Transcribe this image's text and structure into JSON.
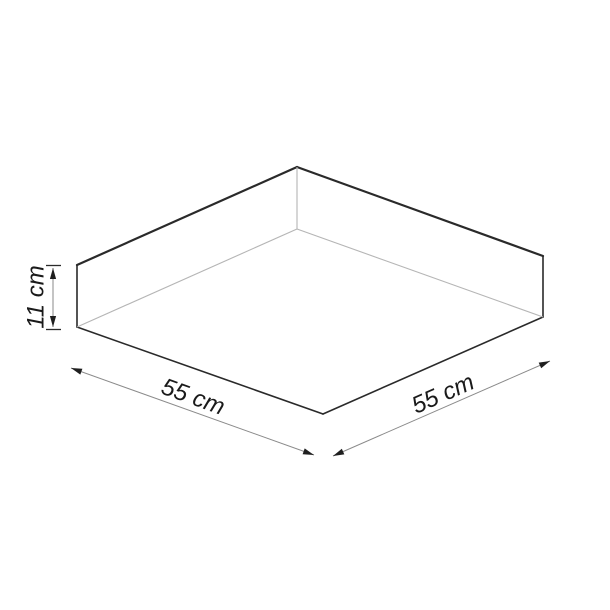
{
  "diagram": {
    "labels": {
      "height": "11 cm",
      "width_left": "55 cm",
      "width_right": "55 cm"
    },
    "colors": {
      "background": "#ffffff",
      "outline": "#2a2a2a",
      "fold_line": "#b5b5b5",
      "dimension_line": "#8a8a8a",
      "arrowhead": "#1f1f1f",
      "label_text": "#1a1a1a"
    }
  }
}
